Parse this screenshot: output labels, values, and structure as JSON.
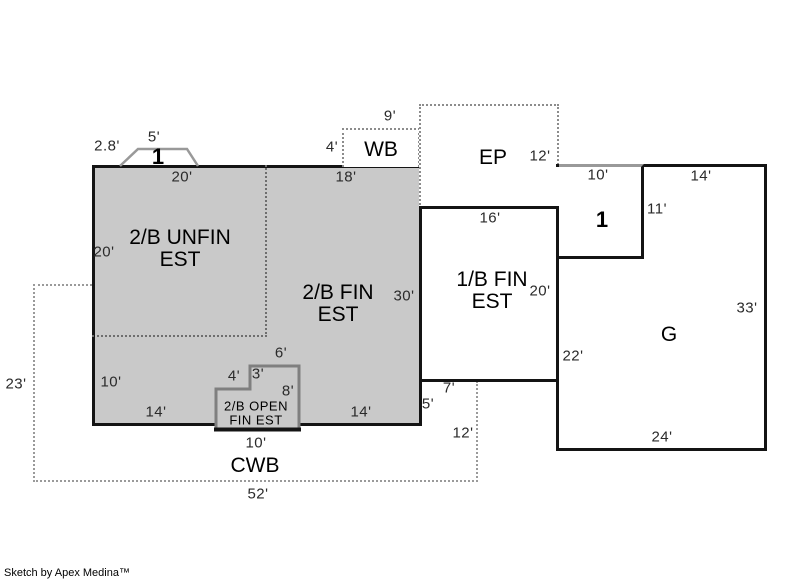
{
  "title": "Floor plan appraisal sketch",
  "footer": {
    "credit": "Sketch by Apex Medina™"
  },
  "colors": {
    "area_fill": "#c9c9c9",
    "wall": "#141414",
    "open_area_border": "#7f7f7f",
    "dashed_gray": "#9a9a9a",
    "partition_dotted": "#6e6e6e",
    "bay_outline": "#999999"
  },
  "areas": [
    "2/B UNFIN EST",
    "2/B FIN EST",
    "1/B FIN EST",
    "EP",
    "WB",
    "CWB",
    "G",
    "1",
    "2/B OPEN FIN EST"
  ],
  "labels": [
    {
      "id": "dim-bay-width",
      "text": "2.8'",
      "x": 107,
      "y": 146,
      "kind": "dim"
    },
    {
      "id": "dim-bay-top",
      "text": "5'",
      "x": 154,
      "y": 137,
      "kind": "dim"
    },
    {
      "id": "marker-bay-1",
      "text": "1",
      "x": 158,
      "y": 157,
      "kind": "marker"
    },
    {
      "id": "dim-top-left",
      "text": "20'",
      "x": 182,
      "y": 177,
      "kind": "dim"
    },
    {
      "id": "dim-top-right",
      "text": "18'",
      "x": 346,
      "y": 177,
      "kind": "dim"
    },
    {
      "id": "dim-wb-top",
      "text": "9'",
      "x": 390,
      "y": 116,
      "kind": "dim"
    },
    {
      "id": "dim-wb-left",
      "text": "4'",
      "x": 332,
      "y": 147,
      "kind": "dim"
    },
    {
      "id": "room-wb",
      "text": "WB",
      "x": 381,
      "y": 150,
      "kind": "room"
    },
    {
      "id": "room-ep",
      "text": "EP",
      "x": 493,
      "y": 158,
      "kind": "room"
    },
    {
      "id": "dim-ep-right",
      "text": "12'",
      "x": 540,
      "y": 156,
      "kind": "dim"
    },
    {
      "id": "dim-1b-top",
      "text": "16'",
      "x": 490,
      "y": 218,
      "kind": "dim"
    },
    {
      "id": "dim-one-top",
      "text": "10'",
      "x": 598,
      "y": 175,
      "kind": "dim"
    },
    {
      "id": "dim-g-top",
      "text": "14'",
      "x": 701,
      "y": 176,
      "kind": "dim"
    },
    {
      "id": "dim-one-right",
      "text": "11'",
      "x": 657,
      "y": 209,
      "kind": "dim"
    },
    {
      "id": "marker-one-1",
      "text": "1",
      "x": 602,
      "y": 220,
      "kind": "marker"
    },
    {
      "id": "room-2b-unfin",
      "text": "2/B UNFIN\nEST",
      "x": 180,
      "y": 249,
      "kind": "room"
    },
    {
      "id": "dim-unfin-left",
      "text": "20'",
      "x": 104,
      "y": 252,
      "kind": "dim"
    },
    {
      "id": "room-2b-fin",
      "text": "2/B FIN\nEST",
      "x": 338,
      "y": 304,
      "kind": "room"
    },
    {
      "id": "dim-fin-right",
      "text": "30'",
      "x": 404,
      "y": 296,
      "kind": "dim"
    },
    {
      "id": "room-1b-fin",
      "text": "1/B FIN\nEST",
      "x": 492,
      "y": 291,
      "kind": "room"
    },
    {
      "id": "dim-1b-right",
      "text": "20'",
      "x": 540,
      "y": 291,
      "kind": "dim"
    },
    {
      "id": "dim-g-left",
      "text": "22'",
      "x": 573,
      "y": 356,
      "kind": "dim"
    },
    {
      "id": "room-g",
      "text": "G",
      "x": 669,
      "y": 335,
      "kind": "room"
    },
    {
      "id": "dim-g-right",
      "text": "33'",
      "x": 747,
      "y": 308,
      "kind": "dim"
    },
    {
      "id": "dim-g-bottom",
      "text": "24'",
      "x": 662,
      "y": 437,
      "kind": "dim"
    },
    {
      "id": "dim-left-lower",
      "text": "10'",
      "x": 111,
      "y": 382,
      "kind": "dim"
    },
    {
      "id": "dim-bottom-left",
      "text": "14'",
      "x": 156,
      "y": 412,
      "kind": "dim"
    },
    {
      "id": "dim-open-top",
      "text": "6'",
      "x": 281,
      "y": 353,
      "kind": "dim"
    },
    {
      "id": "dim-open-left",
      "text": "4'",
      "x": 234,
      "y": 376,
      "kind": "dim"
    },
    {
      "id": "dim-open-step",
      "text": "3'",
      "x": 258,
      "y": 374,
      "kind": "dim"
    },
    {
      "id": "dim-open-right",
      "text": "8'",
      "x": 288,
      "y": 391,
      "kind": "dim"
    },
    {
      "id": "room-2b-open",
      "text": "2/B OPEN\nFIN EST",
      "x": 256,
      "y": 414,
      "kind": "room-sm"
    },
    {
      "id": "dim-open-bottom",
      "text": "10'",
      "x": 256,
      "y": 443,
      "kind": "dim"
    },
    {
      "id": "dim-bottom-right",
      "text": "14'",
      "x": 361,
      "y": 412,
      "kind": "dim"
    },
    {
      "id": "dim-porch-top",
      "text": "7'",
      "x": 449,
      "y": 388,
      "kind": "dim"
    },
    {
      "id": "dim-porch-left",
      "text": "5'",
      "x": 428,
      "y": 404,
      "kind": "dim"
    },
    {
      "id": "dim-cwb-right",
      "text": "12'",
      "x": 463,
      "y": 433,
      "kind": "dim"
    },
    {
      "id": "room-cwb",
      "text": "CWB",
      "x": 255,
      "y": 466,
      "kind": "room"
    },
    {
      "id": "dim-cwb-bottom",
      "text": "52'",
      "x": 258,
      "y": 494,
      "kind": "dim"
    },
    {
      "id": "dim-cwb-left",
      "text": "23'",
      "x": 16,
      "y": 384,
      "kind": "dim"
    }
  ]
}
